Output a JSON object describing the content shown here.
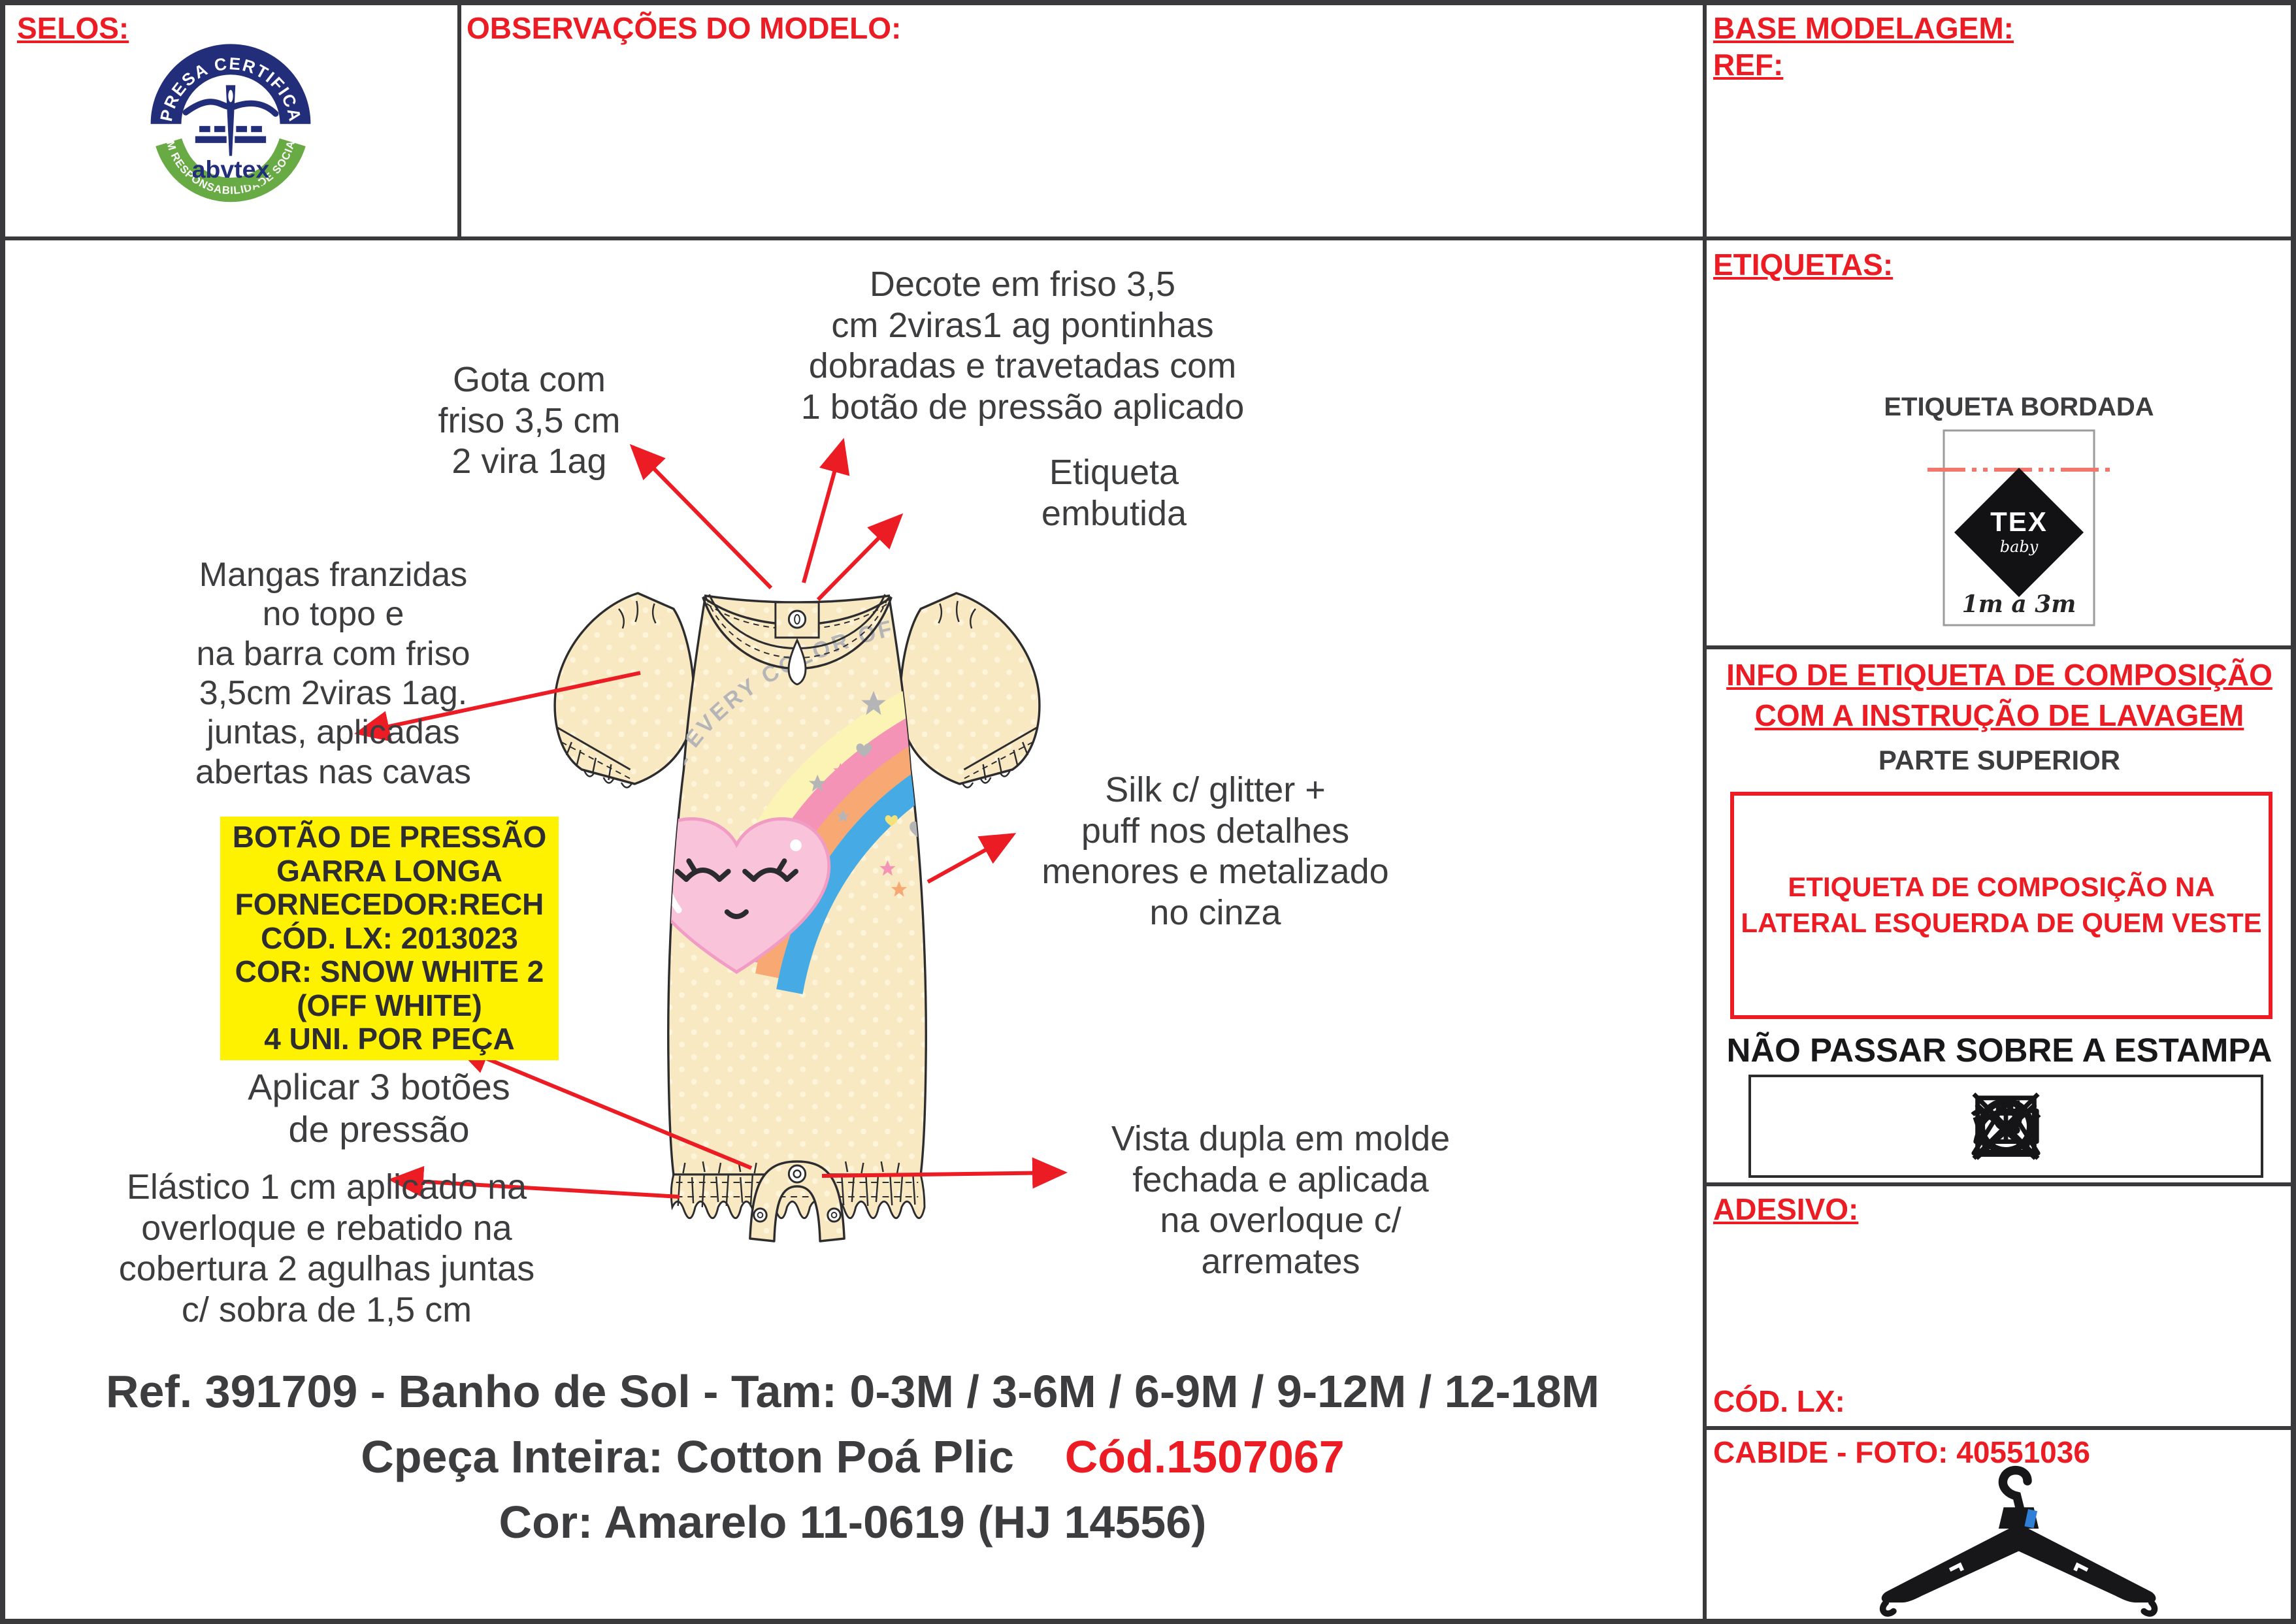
{
  "colors": {
    "accent_red": "#ec1c24",
    "text_dark": "#3d3d3f",
    "line_dark": "#3a3a3c",
    "highlight_yellow": "#fff200",
    "garment_cream": "#f9e9c3",
    "garment_dot": "#fdf4da",
    "rainbow_yellow": "#fcf4b4",
    "rainbow_pink": "#f493b5",
    "rainbow_orange": "#f8a973",
    "rainbow_blue": "#46abe5",
    "heart_pink": "#f9c3d9",
    "heart_outline": "#f09cc4",
    "print_gray": "#b5b5b7",
    "logo_navy": "#232e7a",
    "logo_green": "#68ab45",
    "label_dash_red": "#f2766b"
  },
  "panels": {
    "selos": {
      "title": "SELOS:"
    },
    "observacoes": {
      "title": "OBSERVAÇÕES DO MODELO:"
    },
    "base_modelagem": {
      "title": "BASE MODELAGEM:",
      "ref_label": "REF:"
    },
    "etiquetas": {
      "title": "ETIQUETAS:",
      "subtitle": "ETIQUETA BORDADA",
      "label_brand": "TEX",
      "label_brand_sub": "baby",
      "label_size": "1m a 3m"
    },
    "info_composicao": {
      "title_line1": "INFO DE ETIQUETA DE COMPOSIÇÃO",
      "title_line2": "COM A INSTRUÇÃO DE LAVAGEM",
      "subtitle": "PARTE SUPERIOR",
      "box_line1": "ETIQUETA DE COMPOSIÇÃO NA",
      "box_line2": "LATERAL ESQUERDA DE QUEM VESTE",
      "warning": "NÃO PASSAR SOBRE A ESTAMPA",
      "care_symbols": [
        "hand-wash",
        "do-not-bleach",
        "do-not-tumble-dry",
        "line-dry",
        "iron-low",
        "do-not-dry-clean"
      ]
    },
    "adesivo": {
      "title": "ADESIVO:",
      "cod_lx_label": "CÓD. LX:"
    },
    "cabide": {
      "title": "CABIDE - FOTO: 40551036"
    }
  },
  "logo_abvtex": {
    "top_text": "EMPRESA CERTIFICADA",
    "bottom_text": "EM RESPONSABILIDADE SOCIAL",
    "brand": "abvtex"
  },
  "annotations": {
    "decote": {
      "lines": [
        "Decote em friso 3,5",
        "cm 2viras1 ag pontinhas",
        "dobradas e travetadas com",
        "1 botão de pressão aplicado"
      ]
    },
    "gota": {
      "lines": [
        "Gota com",
        "friso 3,5 cm",
        "2 vira 1ag"
      ]
    },
    "etiqueta_embutida": {
      "lines": [
        "Etiqueta",
        "embutida"
      ]
    },
    "mangas": {
      "lines": [
        "Mangas franzidas",
        "no topo e",
        "na barra com friso",
        "3,5cm 2viras 1ag.",
        "juntas, aplicadas",
        "abertas nas cavas"
      ]
    },
    "botao_pressao": {
      "lines": [
        "BOTÃO DE PRESSÃO",
        "GARRA LONGA",
        "FORNECEDOR:RECH",
        "CÓD. LX: 2013023",
        "COR: SNOW WHITE 2",
        "(OFF WHITE)",
        "4 UNI. POR PEÇA"
      ]
    },
    "aplicar": {
      "lines": [
        "Aplicar 3 botões",
        "de pressão"
      ]
    },
    "elastico": {
      "lines": [
        "Elástico 1 cm aplicado na",
        "overloque e rebatido na",
        "cobertura 2 agulhas juntas",
        "c/ sobra de 1,5 cm"
      ]
    },
    "silk": {
      "lines": [
        "Silk c/ glitter +",
        "puff nos detalhes",
        "menores e metalizado",
        "no cinza"
      ]
    },
    "vista": {
      "lines": [
        "Vista dupla em molde",
        "fechada e aplicada",
        "na overloque c/",
        "arremates"
      ]
    }
  },
  "garment": {
    "print_text": "LOVE EVERY COLOR OF THE RAINBOW"
  },
  "footer": {
    "line1": "Ref. 391709 - Banho de Sol - Tam: 0-3M / 3-6M / 6-9M / 9-12M / 12-18M",
    "line2_dark": "Cpeça Inteira: Cotton Poá Plic",
    "line2_red": "Cód.1507067",
    "line3": "Cor: Amarelo 11-0619 (HJ 14556)"
  }
}
